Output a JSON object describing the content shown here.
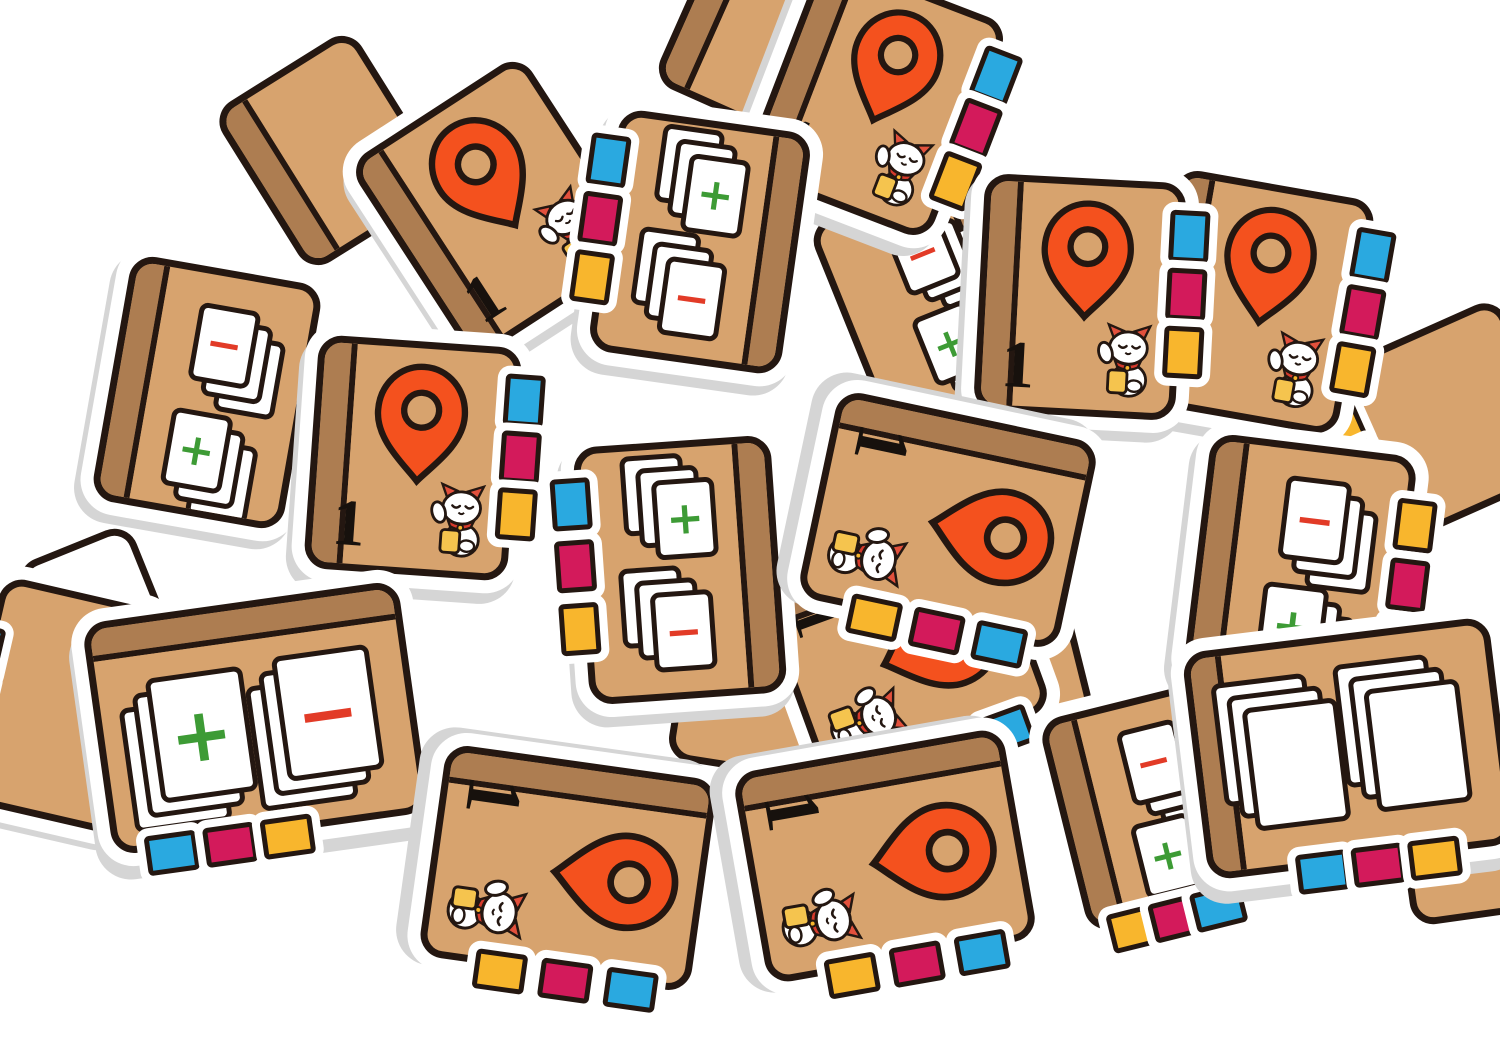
{
  "scene": {
    "width": 1500,
    "height": 1038,
    "background": "#ffffff",
    "description": "pile of cardboard notebook game tiles"
  },
  "palette": {
    "tan": "#d7a36e",
    "spine_brown": "#ad7d51",
    "outline": "#241711",
    "die_white": "#ffffff",
    "thickness_gray": "#d5d5d5",
    "pin_orange": "#f4511e",
    "tab_blue": "#2aa9e0",
    "tab_magenta": "#d31a5b",
    "tab_yellow": "#f8b62d",
    "plus_green": "#3d9b35",
    "minus_red": "#e23b27",
    "card_white": "#ffffff",
    "cat_ear_red": "#e2503c",
    "cat_collar_red": "#d63a2c",
    "coin_gold": "#f5c44e"
  },
  "labels": {
    "number": "1",
    "plus": "+",
    "minus": "−"
  },
  "icons": {
    "pin": "map-pin-icon",
    "cat": "lucky-cat-icon",
    "tab": "index-tab",
    "cards": "card-stack"
  },
  "tiles": [
    {
      "name": "fragment-tile-top-center-back",
      "type": "blank",
      "cx": 760,
      "cy": 50,
      "w": 200,
      "h": 170,
      "rot": 24,
      "spine": "left",
      "shadow": [
        0,
        0
      ]
    },
    {
      "name": "fragment-tile-top-left-back",
      "type": "blank",
      "cx": 330,
      "cy": 150,
      "w": 190,
      "h": 215,
      "rot": -32,
      "spine": "left",
      "shadow": [
        0,
        0
      ]
    },
    {
      "name": "white-back-tile-left",
      "type": "white-back",
      "cx": 100,
      "cy": 618,
      "w": 150,
      "h": 185,
      "rot": -22,
      "shadow": [
        0,
        0
      ]
    },
    {
      "name": "blank-tile-left-edge",
      "type": "blank",
      "cx": 60,
      "cy": 705,
      "w": 195,
      "h": 255,
      "rot": 13,
      "tabs": {
        "side": "left",
        "colors": [
          "blue",
          "magenta",
          "yellow"
        ],
        "positions": [
          0.26,
          0.45,
          0.64
        ]
      },
      "shadow": [
        0,
        6
      ]
    },
    {
      "name": "blank-tile-middle-filler",
      "type": "blank",
      "cx": 950,
      "cy": 655,
      "w": 280,
      "h": 215,
      "rot": -14,
      "shadow": [
        0,
        0
      ]
    },
    {
      "name": "blank-tile-center-filler",
      "type": "blank",
      "cx": 775,
      "cy": 700,
      "w": 225,
      "h": 175,
      "rot": 9,
      "shadow": [
        0,
        0
      ]
    },
    {
      "name": "fragment-tile-right-edge",
      "type": "blank",
      "cx": 1448,
      "cy": 420,
      "w": 215,
      "h": 215,
      "rot": -24,
      "tabs": {
        "side": "left",
        "colors": [
          "yellow",
          "magenta",
          "blue"
        ],
        "positions": [
          0.2,
          0.42,
          0.64
        ]
      },
      "shadow": [
        0,
        0
      ]
    },
    {
      "name": "fragment-tile-right-bottom",
      "type": "blank",
      "cx": 1478,
      "cy": 800,
      "w": 190,
      "h": 260,
      "rot": -8,
      "shadow": [
        0,
        0
      ]
    },
    {
      "name": "cards-tile-buried-top-middle",
      "type": "cards",
      "cx": 930,
      "cy": 295,
      "w": 205,
      "h": 245,
      "rot": -22,
      "spine": "right",
      "layout": "v",
      "groups": [
        {
          "symbol": "minus",
          "fan": [
            14,
            13
          ]
        },
        {
          "symbol": "plus",
          "fan": [
            14,
            13
          ]
        }
      ],
      "shadow": [
        0,
        0
      ]
    },
    {
      "name": "cards-tile-buried-right",
      "type": "cards",
      "cx": 1300,
      "cy": 645,
      "w": 255,
      "h": 215,
      "rot": -12,
      "layout": "h",
      "groups": [
        {
          "symbol": "none",
          "fan": [
            -13,
            -13
          ]
        },
        {
          "symbol": "none",
          "fan": [
            -13,
            -13
          ]
        }
      ],
      "shadow": [
        0,
        0
      ]
    },
    {
      "name": "pin-tile-buried-center",
      "type": "pin",
      "cx": 905,
      "cy": 650,
      "w": 235,
      "h": 265,
      "rot": 70,
      "spine": "left",
      "tabs": {
        "side": "right",
        "colors": [
          "blue",
          "magenta",
          "yellow"
        ]
      },
      "shadow": [
        0,
        0
      ]
    },
    {
      "name": "cards-tile-buried-bottom-right",
      "type": "cards",
      "cx": 1155,
      "cy": 805,
      "w": 215,
      "h": 245,
      "rot": -14,
      "spine": "left",
      "layout": "v",
      "tabs": {
        "side": "bottom",
        "colors": [
          "yellow",
          "magenta",
          "blue"
        ]
      },
      "groups": [
        {
          "symbol": "minus",
          "fan": [
            12,
            14
          ]
        },
        {
          "symbol": "plus",
          "fan": [
            12,
            14
          ]
        }
      ],
      "shadow": [
        0,
        0
      ]
    },
    {
      "name": "cards-tile-top-left",
      "type": "cards",
      "cx": 207,
      "cy": 392,
      "w": 220,
      "h": 275,
      "rot": 10,
      "spine": "left",
      "layout": "v",
      "groups": [
        {
          "symbol": "minus",
          "fan": [
            15,
            13
          ]
        },
        {
          "symbol": "plus",
          "fan": [
            15,
            13
          ]
        }
      ],
      "shadow": [
        -5,
        9
      ]
    },
    {
      "name": "pin-tile-upper-left",
      "type": "pin",
      "cx": 497,
      "cy": 207,
      "w": 232,
      "h": 260,
      "rot": -33,
      "spine": "left",
      "shadow": [
        -5,
        9
      ]
    },
    {
      "name": "pin-tile-top-center",
      "type": "pin",
      "cx": 875,
      "cy": 98,
      "w": 225,
      "h": 258,
      "rot": 21,
      "spine": "left",
      "tabs": {
        "side": "right",
        "colors": [
          "blue",
          "magenta",
          "yellow"
        ]
      },
      "shadow": [
        -7,
        11
      ]
    },
    {
      "name": "cards-tile-top-middle",
      "type": "cards",
      "cx": 700,
      "cy": 242,
      "w": 220,
      "h": 270,
      "rot": 8,
      "spine": "right",
      "layout": "v",
      "tabs": {
        "side": "left",
        "colors": [
          "blue",
          "magenta",
          "yellow"
        ]
      },
      "groups": [
        {
          "symbol": "plus",
          "fan": [
            -15,
            -13
          ]
        },
        {
          "symbol": "minus",
          "fan": [
            -15,
            -13
          ]
        }
      ],
      "shadow": [
        -5,
        10
      ]
    },
    {
      "name": "pin-tile-top-right-outer",
      "type": "pin",
      "cx": 1257,
      "cy": 302,
      "w": 228,
      "h": 264,
      "rot": 10,
      "spine": "left",
      "tabs": {
        "side": "right",
        "colors": [
          "blue",
          "magenta",
          "yellow"
        ]
      },
      "shadow": [
        -5,
        10
      ]
    },
    {
      "name": "pin-tile-top-right-inner",
      "type": "pin",
      "cx": 1080,
      "cy": 297,
      "w": 228,
      "h": 264,
      "rot": 3,
      "spine": "left",
      "tabs": {
        "side": "right",
        "colors": [
          "blue",
          "magenta",
          "yellow"
        ]
      },
      "shadow": [
        -6,
        10
      ]
    },
    {
      "name": "pin-tile-center-left",
      "type": "pin",
      "cx": 413,
      "cy": 458,
      "w": 230,
      "h": 260,
      "rot": 4,
      "spine": "left",
      "tabs": {
        "side": "right",
        "colors": [
          "blue",
          "magenta",
          "yellow"
        ]
      },
      "shadow": [
        -5,
        11
      ]
    },
    {
      "name": "cards-tile-center",
      "type": "cards",
      "cx": 680,
      "cy": 570,
      "w": 224,
      "h": 284,
      "rot": -4,
      "spine": "right",
      "layout": "v",
      "tabs": {
        "side": "left",
        "colors": [
          "blue",
          "magenta",
          "yellow"
        ]
      },
      "groups": [
        {
          "symbol": "plus",
          "fan": [
            -15,
            -13
          ]
        },
        {
          "symbol": "minus",
          "fan": [
            -15,
            -13
          ]
        }
      ],
      "shadow": [
        -5,
        10
      ]
    },
    {
      "name": "pin-tile-center-sideways",
      "type": "pin",
      "cx": 948,
      "cy": 520,
      "w": 238,
      "h": 292,
      "rot": 102,
      "spine": "left",
      "tabs": {
        "side": "right",
        "colors": [
          "blue",
          "magenta",
          "yellow"
        ]
      },
      "shadow": [
        -5,
        12
      ]
    },
    {
      "name": "cards-tile-right",
      "type": "cards",
      "cx": 1300,
      "cy": 568,
      "w": 234,
      "h": 274,
      "rot": 7,
      "spine": "left",
      "layout": "v",
      "tabs": {
        "side": "right",
        "colors": [
          "yellow",
          "magenta",
          "blue"
        ],
        "positions": [
          0.2,
          0.42,
          0.64
        ]
      },
      "groups": [
        {
          "symbol": "minus",
          "fan": [
            15,
            13
          ]
        },
        {
          "symbol": "plus",
          "fan": [
            15,
            13
          ]
        }
      ],
      "shadow": [
        -6,
        11
      ]
    },
    {
      "name": "cards-tile-bottom-left",
      "type": "cards",
      "cx": 255,
      "cy": 718,
      "w": 345,
      "h": 260,
      "rot": -8,
      "spine": "top",
      "layout": "h",
      "tabs": {
        "side": "bottom",
        "colors": [
          "blue",
          "magenta",
          "yellow"
        ],
        "positions": [
          0.13,
          0.3,
          0.47
        ]
      },
      "groups": [
        {
          "symbol": "plus",
          "fan": [
            -15,
            13
          ]
        },
        {
          "symbol": "minus",
          "fan": [
            -15,
            13
          ]
        }
      ],
      "shadow": [
        -4,
        13
      ]
    },
    {
      "name": "cards-tile-bottom-right",
      "type": "cards",
      "cx": 1348,
      "cy": 748,
      "w": 335,
      "h": 255,
      "rot": -7,
      "spine": "left",
      "layout": "h",
      "tabs": {
        "side": "bottom",
        "colors": [
          "blue",
          "magenta",
          "yellow"
        ],
        "positions": [
          0.3,
          0.47,
          0.64
        ]
      },
      "groups": [
        {
          "symbol": "none",
          "fan": [
            -14,
            -14
          ]
        },
        {
          "symbol": "none",
          "fan": [
            -14,
            -14
          ]
        }
      ],
      "shadow": [
        -4,
        12
      ]
    },
    {
      "name": "pin-tile-bottom-left-sideways",
      "type": "pin",
      "cx": 568,
      "cy": 868,
      "w": 240,
      "h": 300,
      "rot": 98,
      "spine": "left",
      "tabs": {
        "side": "right",
        "colors": [
          "blue",
          "magenta",
          "yellow"
        ]
      },
      "shadow": [
        -4,
        12
      ]
    },
    {
      "name": "pin-tile-bottom-center-sideways",
      "type": "pin",
      "cx": 885,
      "cy": 856,
      "w": 240,
      "h": 300,
      "rot": 80,
      "spine": "left",
      "tabs": {
        "side": "right",
        "colors": [
          "blue",
          "magenta",
          "yellow"
        ]
      },
      "shadow": [
        -4,
        12
      ]
    }
  ]
}
